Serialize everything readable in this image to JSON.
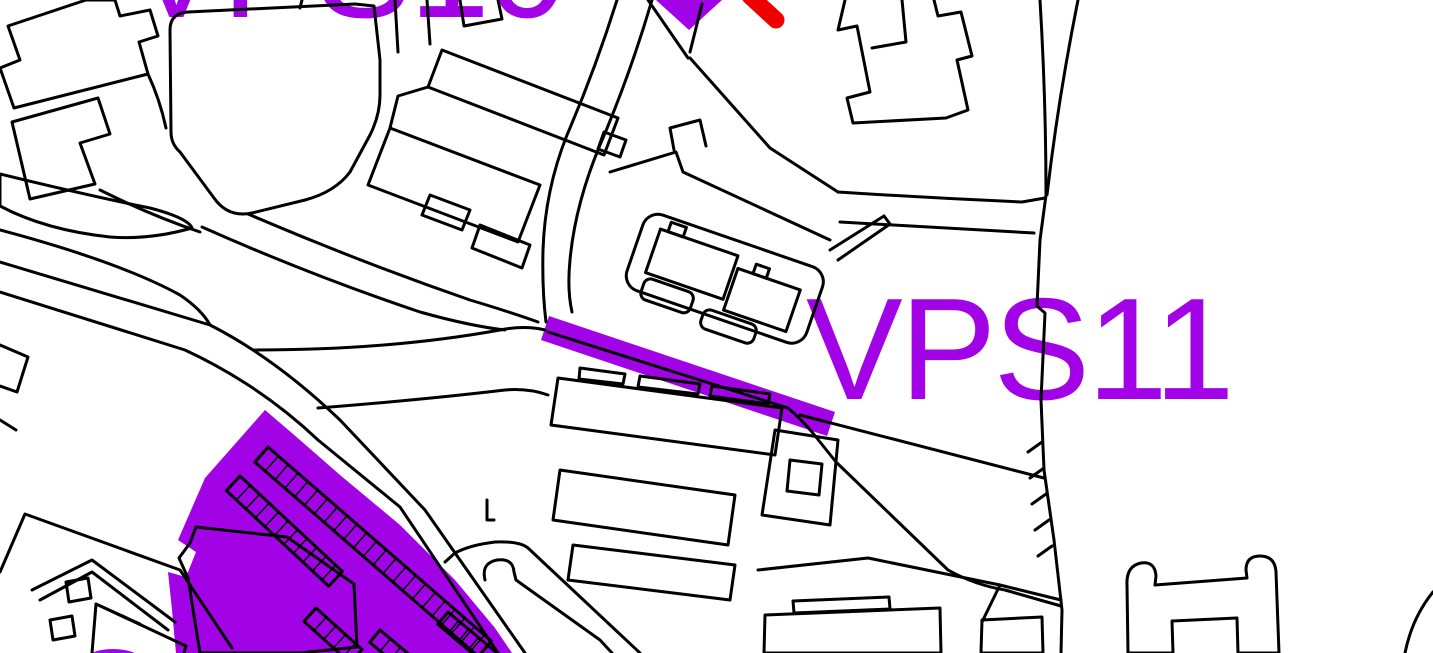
{
  "canvas": {
    "width": 1433,
    "height": 653
  },
  "colors": {
    "background": "#FFFFFF",
    "line": "#000000",
    "purple": "#A203E6",
    "red": "#EF0000",
    "white": "#FFFFFF"
  },
  "labels": {
    "main_site_code": "VPS11",
    "top_partial_site_code": "VPS10"
  },
  "features": {
    "map_type": "planning-allocation-map",
    "highlighted_road_segment_color": "purple",
    "allocation_zone_color": "purple",
    "triangle_marker_color": "purple",
    "stroke_marker_color": "red",
    "linework_color": "black"
  }
}
